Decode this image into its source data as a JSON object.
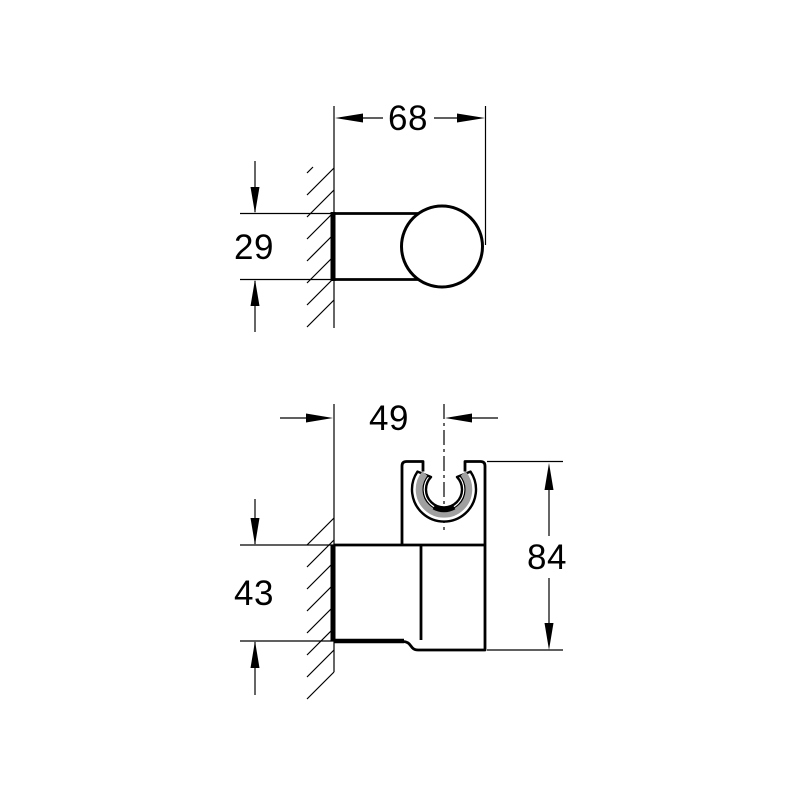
{
  "drawing": {
    "background_color": "#ffffff",
    "line_color": "#000000",
    "shading_color": "#a0a0a0",
    "views": {
      "upper": {
        "dims": {
          "width": "68",
          "depth": "29"
        }
      },
      "lower": {
        "dims": {
          "center_offset": "49",
          "wall_plate_height": "43",
          "overall_height": "84"
        }
      }
    }
  }
}
